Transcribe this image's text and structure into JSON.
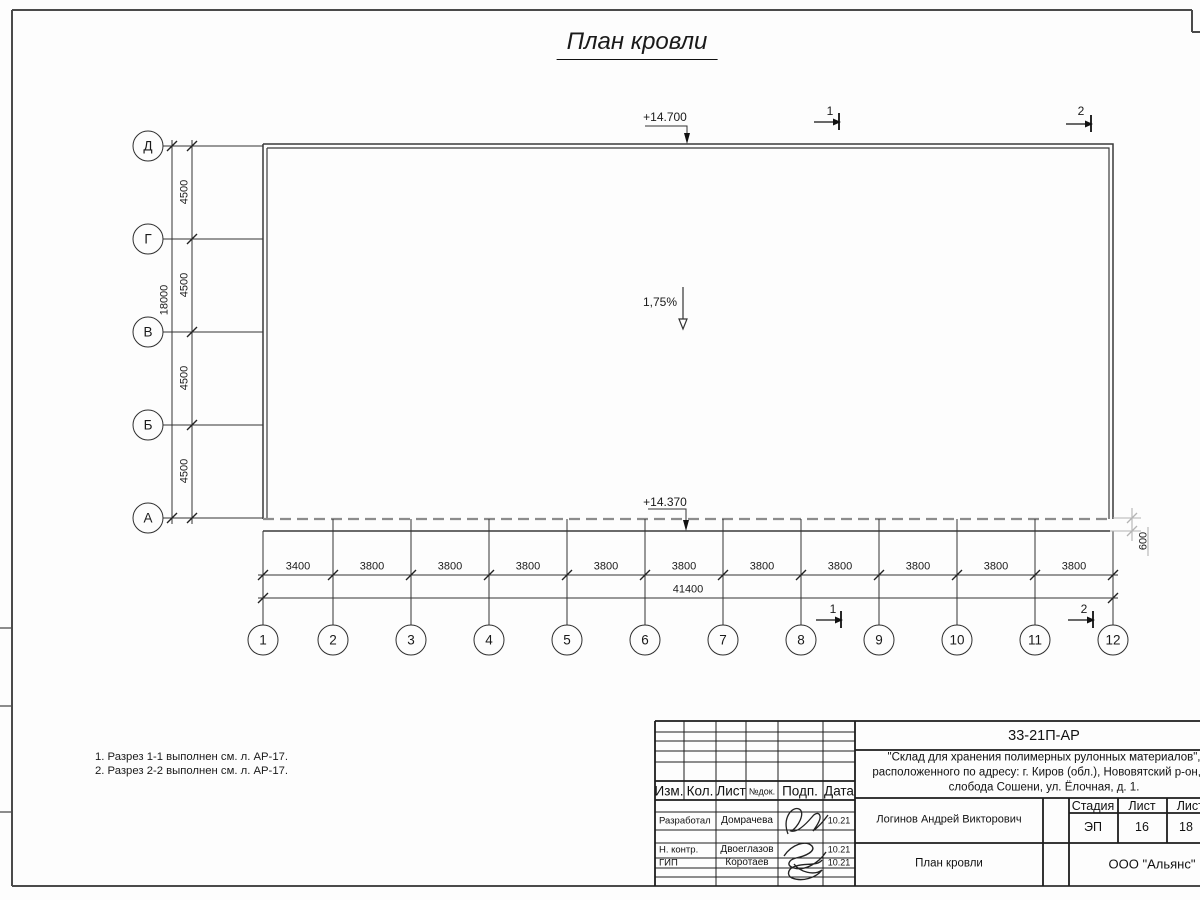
{
  "sheet": {
    "title": "План кровли"
  },
  "axes": {
    "rows": [
      "Д",
      "Г",
      "В",
      "Б",
      "А"
    ],
    "cols": [
      "1",
      "2",
      "3",
      "4",
      "5",
      "6",
      "7",
      "8",
      "9",
      "10",
      "11",
      "12"
    ]
  },
  "dimensions": {
    "row_bays": [
      "4500",
      "4500",
      "4500",
      "4500"
    ],
    "row_total": "18000",
    "col_bays": [
      "3400",
      "3800",
      "3800",
      "3800",
      "3800",
      "3800",
      "3800",
      "3800",
      "3800",
      "3800",
      "3800"
    ],
    "col_total": "41400",
    "eave_offset": "600"
  },
  "annotations": {
    "elevation_top": "+14.700",
    "elevation_bottom": "+14.370",
    "slope": "1,75%",
    "section_1": "1",
    "section_2": "2",
    "notes": [
      "1. Разрез 1-1 выполнен см. л. АР-17.",
      "2. Разрез 2-2 выполнен см. л. АР-17."
    ]
  },
  "title_block": {
    "doc_number": "33-21П-АР",
    "project_description": [
      "\"Склад для хранения полимерных рулонных материалов\",",
      "расположенного по адресу: г. Киров (обл.), Нововятский р-он, те",
      "слобода Сошени, ул. Ёлочная, д. 1."
    ],
    "columns": {
      "izm": "Изм.",
      "kol": "Кол.",
      "list": "Лист",
      "doc": "№док.",
      "sign": "Подп.",
      "date": "Дата"
    },
    "signature_rows": [
      {
        "role": "Разработал",
        "name": "Домрачева",
        "date": "10.21"
      },
      {
        "role": "Н. контр.",
        "name": "Двоеглазов",
        "date": "10.21"
      },
      {
        "role": "ГИП",
        "name": "Коротаев",
        "date": "10.21"
      }
    ],
    "approved_by": "Логинов Андрей Викторович",
    "drawing_name": "План кровли",
    "organization": "ООО \"Альянс\"",
    "stage_label": "Стадия",
    "sheet_label": "Лист",
    "sheets_label": "Листов",
    "stage_value": "ЭП",
    "sheet_value": "16",
    "sheets_value": "18"
  }
}
